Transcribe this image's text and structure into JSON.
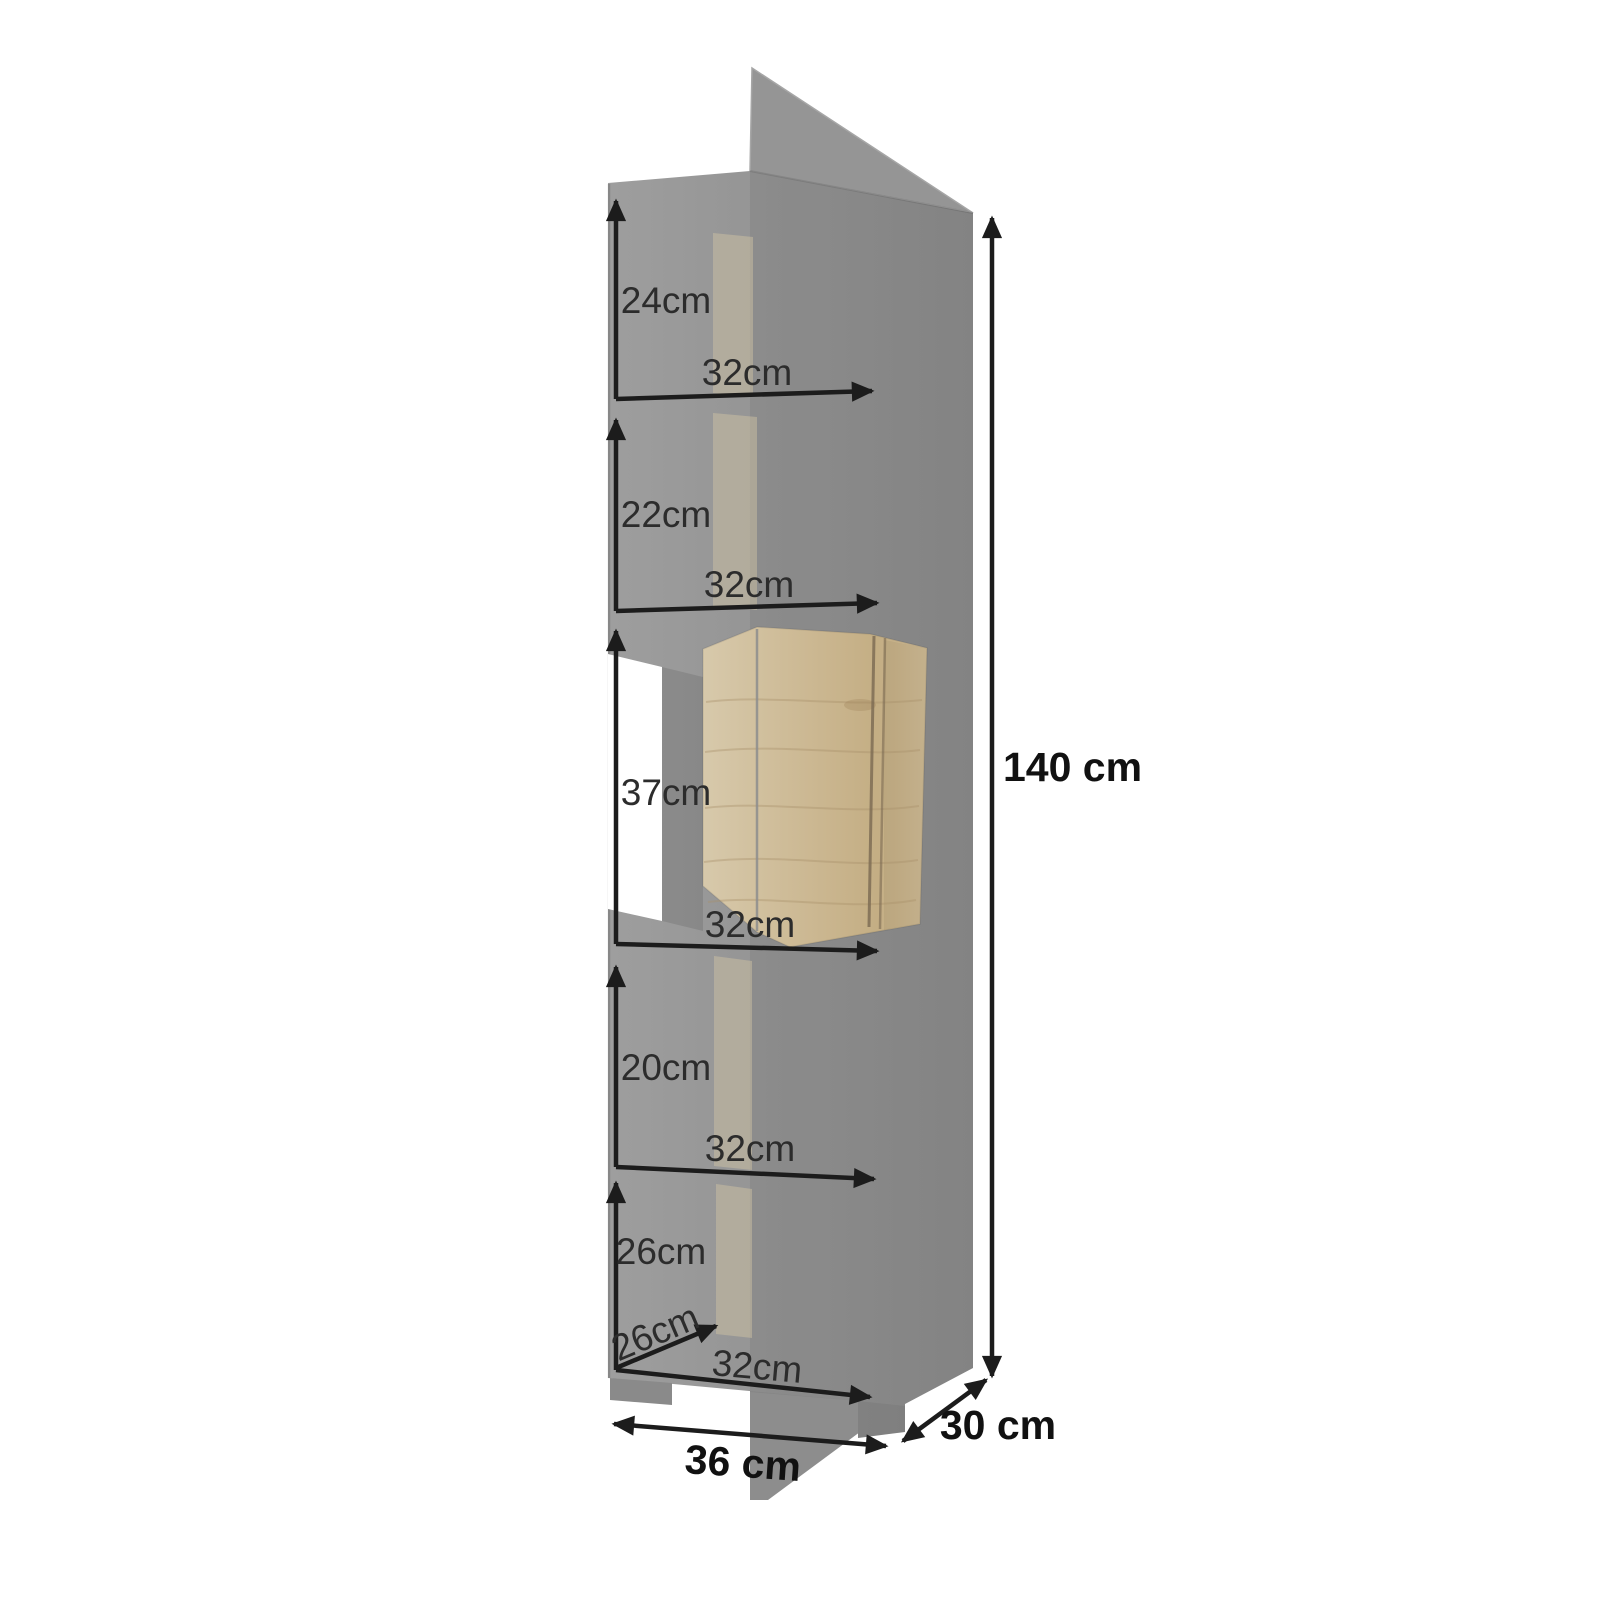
{
  "diagram": {
    "type": "furniture-dimension-diagram",
    "subject": "tall narrow display cabinet, 3d render with dimension arrows",
    "overall": {
      "height": "140 cm",
      "width": "36 cm",
      "depth": "30 cm"
    },
    "compartments": [
      {
        "position": "top",
        "height": "24cm",
        "width": "32cm"
      },
      {
        "position": "second",
        "height": "22cm",
        "width": "32cm"
      },
      {
        "position": "middle-wood-door",
        "height": "37cm",
        "width": "32cm"
      },
      {
        "position": "fourth",
        "height": "20cm",
        "width": "32cm"
      },
      {
        "position": "bottom",
        "height": "26cm",
        "width": "32cm",
        "depth": "26cm"
      }
    ],
    "colors": {
      "background": "#ffffff",
      "cabinet_gray": "#969696",
      "cabinet_gray_dark": "#8b8b8b",
      "wood_door": "#c9b58f",
      "dimension_line": "#1c1c1c"
    }
  }
}
